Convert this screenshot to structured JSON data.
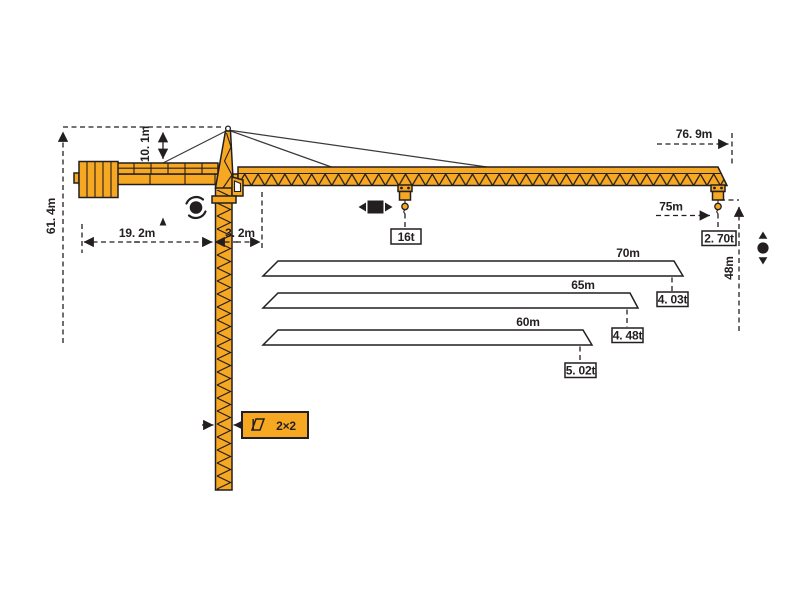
{
  "diagram": {
    "title": "tower-crane-specification-diagram",
    "colors": {
      "crane_fill": "#f7a823",
      "line_color": "#231f20",
      "label_box_bg": "#ffffff"
    },
    "dimensions": {
      "total_height": "61. 4m",
      "head_height": "10. 1m",
      "counterjib_length": "19. 2m",
      "rear_offset": "3. 2m",
      "jib_overall_length": "76. 9m",
      "max_radius": "75m",
      "tip_load": "2. 70t",
      "hook_height": "48m",
      "max_load": "16t",
      "mast_section": "2×2"
    },
    "jib_variants": [
      {
        "length": "70m",
        "tip_load": "4. 03t"
      },
      {
        "length": "65m",
        "tip_load": "4. 48t"
      },
      {
        "length": "60m",
        "tip_load": "5. 02t"
      }
    ],
    "icons": {
      "slewing": "slewing-rotation-icon",
      "trolley": "trolley-travel-icon",
      "hoist": "hoist-up-down-icon",
      "section": "mast-section-icon"
    }
  }
}
